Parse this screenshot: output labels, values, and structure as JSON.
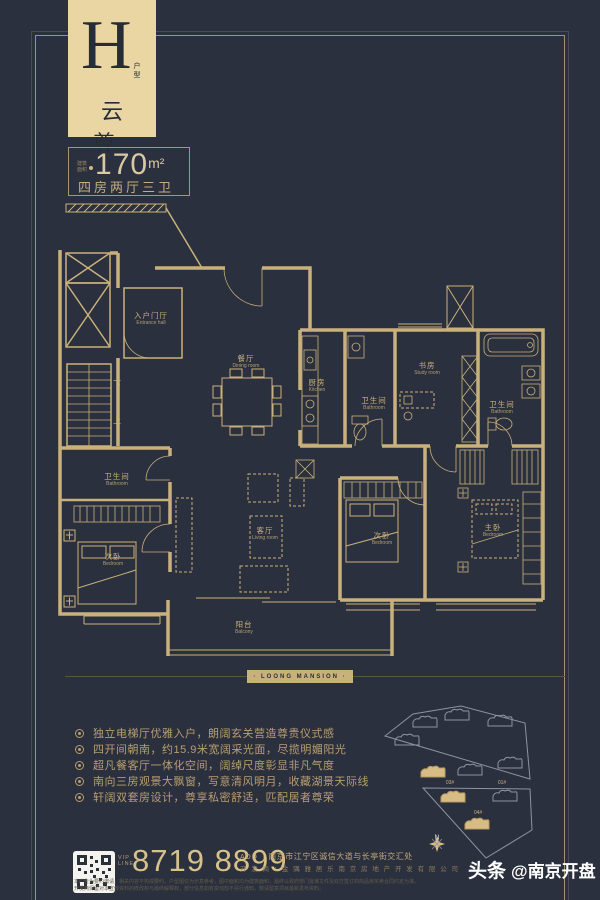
{
  "header": {
    "letter": "H",
    "letter_sub": "户型",
    "name_cn": "云 尊",
    "area_label_lines": [
      "建筑",
      "面积"
    ],
    "area_value": "170",
    "area_unit": "m²",
    "layout": "四房两厅三卫"
  },
  "brand": {
    "band_text": "· LOONG MANSION ·"
  },
  "floorplan": {
    "rooms": [
      {
        "id": "entrance-hall",
        "cn": "入户门厅",
        "en": "Entrance hall",
        "x": 151,
        "y": 319
      },
      {
        "id": "dining-room",
        "cn": "餐厅",
        "en": "Dining room",
        "x": 246,
        "y": 362
      },
      {
        "id": "kitchen",
        "cn": "厨房",
        "en": "Kitchen",
        "x": 317,
        "y": 386
      },
      {
        "id": "bathroom-inner",
        "cn": "卫生间",
        "en": "Bathroom",
        "x": 374,
        "y": 404
      },
      {
        "id": "study-room",
        "cn": "书房",
        "en": "Study room",
        "x": 427,
        "y": 369
      },
      {
        "id": "bathroom-master",
        "cn": "卫生间",
        "en": "Bathroom",
        "x": 502,
        "y": 408
      },
      {
        "id": "living-room",
        "cn": "客厅",
        "en": "Living room",
        "x": 265,
        "y": 534
      },
      {
        "id": "bathroom-left",
        "cn": "卫生间",
        "en": "Bathroom",
        "x": 117,
        "y": 480
      },
      {
        "id": "bedroom-left",
        "cn": "次卧",
        "en": "Bedroom",
        "x": 113,
        "y": 560
      },
      {
        "id": "bedroom-mid",
        "cn": "次卧",
        "en": "Bedroom",
        "x": 382,
        "y": 539
      },
      {
        "id": "bedroom-master",
        "cn": "主卧",
        "en": "Bedroom",
        "x": 493,
        "y": 531
      },
      {
        "id": "balcony",
        "cn": "阳台",
        "en": "Balcony",
        "x": 244,
        "y": 628
      }
    ],
    "stairs": [
      {
        "id": "stairs-down",
        "text": "下",
        "x": 117,
        "y": 384
      },
      {
        "id": "stairs-up",
        "text": "上",
        "x": 117,
        "y": 421
      }
    ]
  },
  "features": {
    "items": [
      "独立电梯厅优雅入户，朗阔玄关营造尊贵仪式感",
      "四开间朝南，约15.9米宽阔采光面，尽揽明媚阳光",
      "超凡餐客厅一体化空间，阔绰尺度彰显非凡气度",
      "南向三房观景大飘窗，写意清风明月，收藏湖景天际线",
      "轩阔双套房设计，尊享私密舒适，匹配居者尊荣"
    ]
  },
  "sitemap": {
    "labels": [
      {
        "text": "03#",
        "x": 450,
        "y": 783
      },
      {
        "text": "01#",
        "x": 502,
        "y": 783
      },
      {
        "text": "04#",
        "x": 478,
        "y": 813
      }
    ],
    "north": "N"
  },
  "contact": {
    "vip_lines": [
      "VIP",
      "LINE"
    ],
    "phone": "8719 8899",
    "add_label": "ADD",
    "divider": "｜",
    "address": "南京市江宁区诚信大道与长亭街交汇处",
    "developer": "开 发 商 ：金 隅 雅 居 乐 南 京 房 地 产 开 发 有 限 公 司"
  },
  "legal": {
    "line1": "本广告为要约邀请，相关内容不构成要约。户型图仅为示意参考，图中面积均为建筑面积，最终以政府部门批准文件及双方签订的商品房买卖合同约定为准。",
    "line2": "开发商保留对本宣传资料的修改权与最终解释权，部分信息如有变动恕不另行通知，敬请留意项目最新发布资料。"
  },
  "watermark": {
    "bold": "头条",
    "rest": "@南京开盘"
  }
}
